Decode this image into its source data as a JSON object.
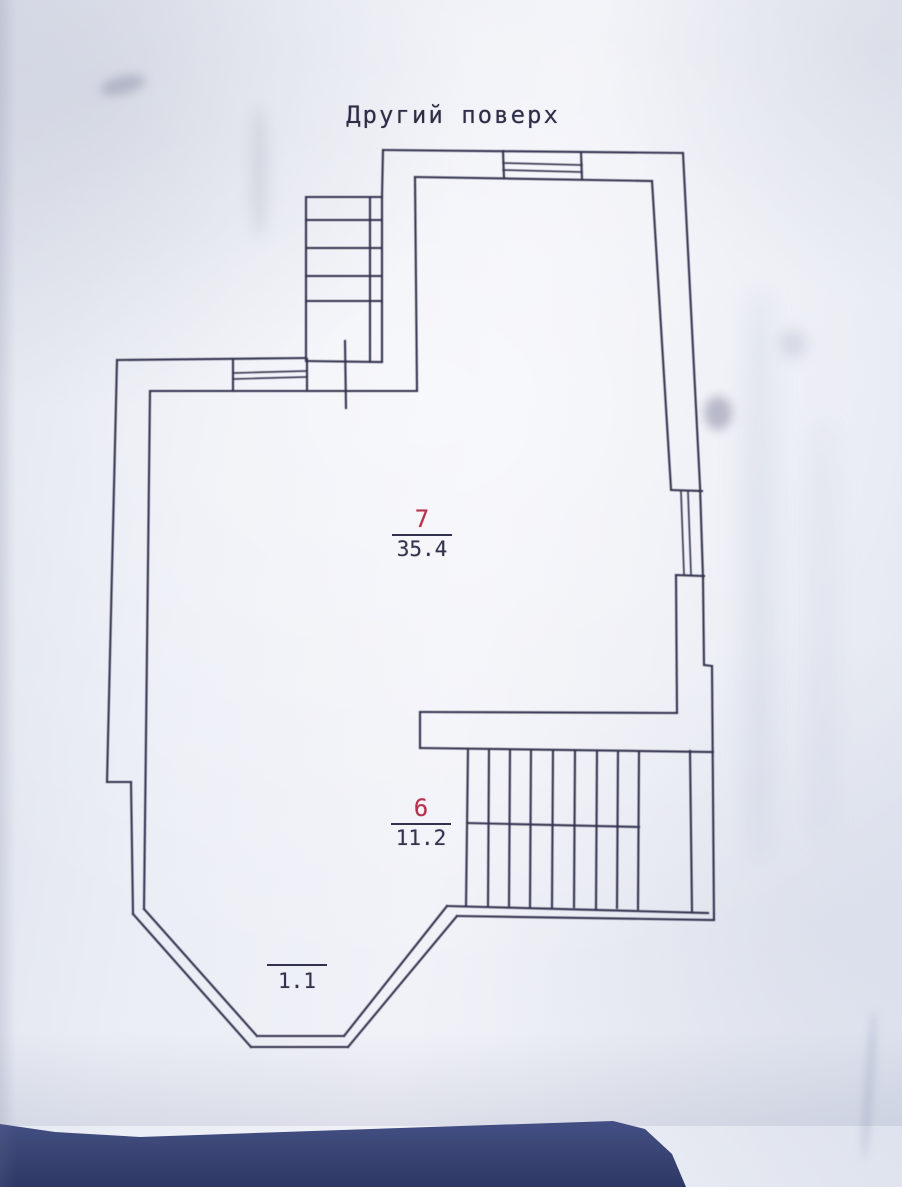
{
  "photo": {
    "title": "Другий поверх",
    "rooms": [
      {
        "number": "7",
        "area": "35.4"
      },
      {
        "number": "6",
        "area": "11.2"
      }
    ],
    "balcony": {
      "area": "1.1"
    },
    "colors": {
      "ink": "#32324e",
      "room_number_red": "#b5314d",
      "paper": "#e9ecf4",
      "table_band": "#3d4878"
    }
  }
}
